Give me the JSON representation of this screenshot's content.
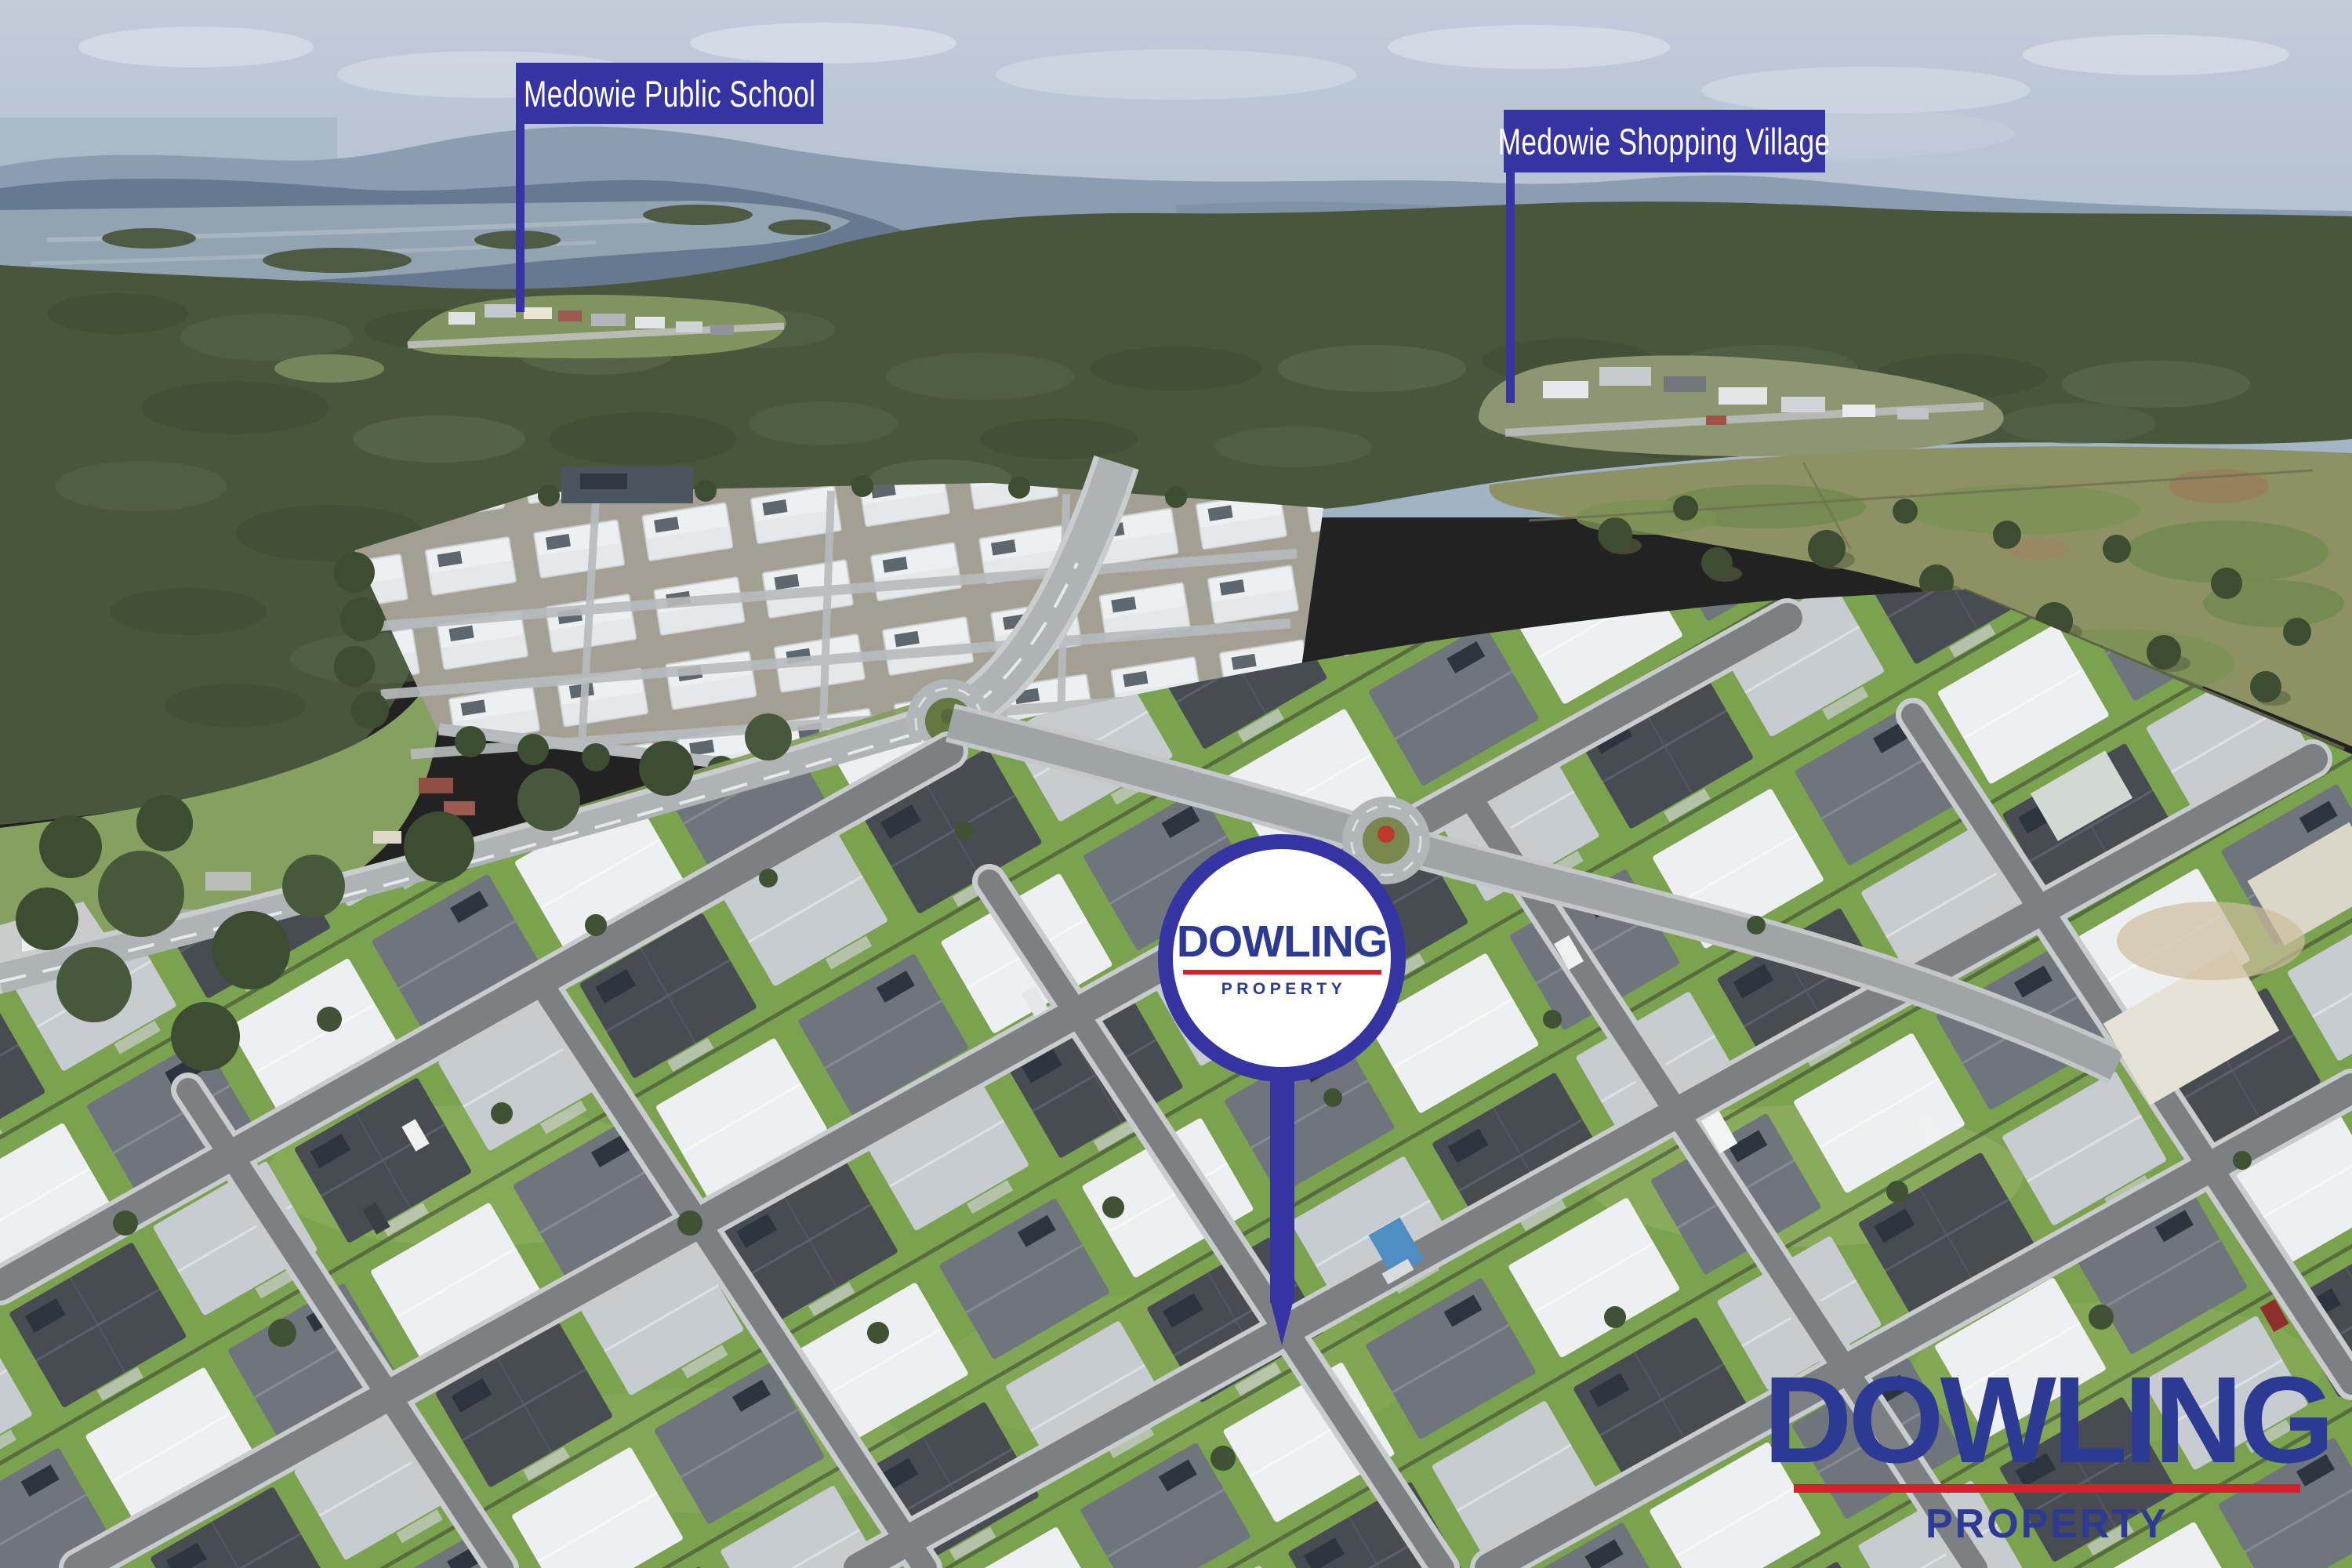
{
  "labels": {
    "school": "Medowie Public School",
    "shopping_village": "Medowie Shopping Village"
  },
  "pin": {
    "brand": "DOWLING",
    "division": "PROPERTY"
  },
  "watermark": {
    "brand": "DOWLING",
    "division": "PROPERTY"
  },
  "colors": {
    "annotation_blue": "#3634a2",
    "brand_navy": "#2c3a94",
    "brand_red": "#d81f2a"
  }
}
